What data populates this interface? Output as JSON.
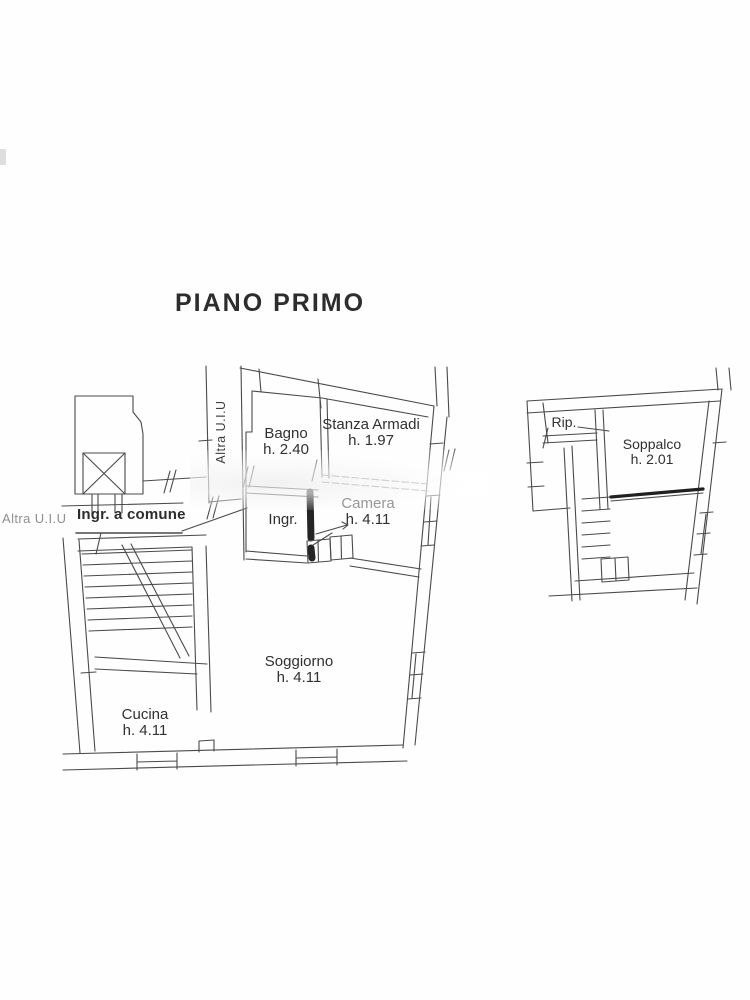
{
  "title": "PIANO PRIMO",
  "margin_note": "Altra U.I.U",
  "plan": {
    "vertical_label": "Altra U.I.U",
    "common_entrance_label": "Ingr. a comune",
    "rooms": [
      {
        "id": "bagno",
        "name": "Bagno",
        "height": "h. 2.40"
      },
      {
        "id": "stanza-armadi",
        "name": "Stanza Armadi",
        "height": "h. 1.97"
      },
      {
        "id": "ingresso",
        "name": "Ingr.",
        "height": ""
      },
      {
        "id": "camera",
        "name": "Camera",
        "height": "h. 4.11"
      },
      {
        "id": "soggiorno",
        "name": "Soggiorno",
        "height": "h. 4.11"
      },
      {
        "id": "cucina",
        "name": "Cucina",
        "height": "h. 4.11"
      },
      {
        "id": "ripostiglio",
        "name": "Rip.",
        "height": ""
      },
      {
        "id": "soppalco",
        "name": "Soppalco",
        "height": "h. 2.01"
      }
    ],
    "colors": {
      "line": "#4a4a4a",
      "dark_wall": "#242424",
      "ink": "#2d2d2d",
      "faded_line": "#8a8a8a",
      "muted_text": "#8f8f8f"
    }
  }
}
